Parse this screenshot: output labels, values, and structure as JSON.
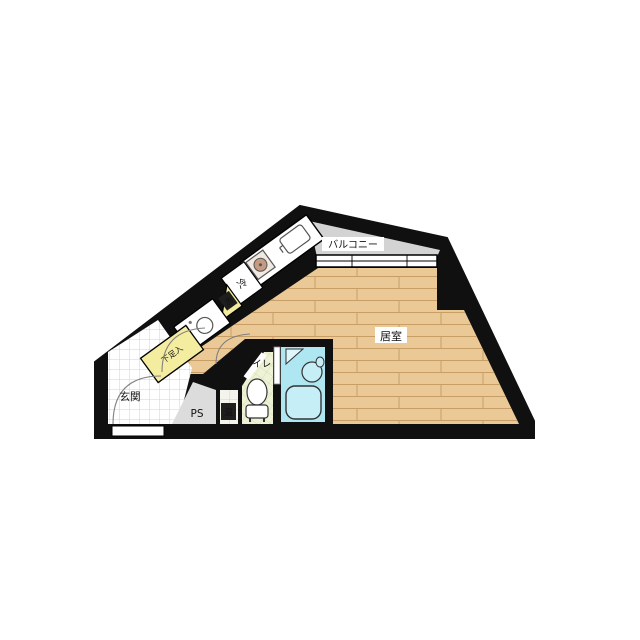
{
  "image": {
    "type": "apartment-floor-plan"
  },
  "labels": {
    "balcony": "バルコニー",
    "living_room": "居室",
    "entrance": "玄関",
    "toilet": "トイレ",
    "pipe_space": "PS",
    "water_heater": "温",
    "refrigerator": "冷",
    "shoe_cabinet": "下足入",
    "washer": "洗"
  },
  "colors": {
    "wall": "#101010",
    "wood_floor": "#ebc996",
    "wood_line": "#c79e66",
    "balcony_floor": "#d3d3d3",
    "bath_floor": "#aee6f2",
    "bath_fixture": "#c6eef7",
    "toilet_floor": "#eef3d7",
    "shoe_yellow": "#f4eda0",
    "entrance_floor": "#ffffff",
    "ps_floor": "#dcdcdc",
    "heater_floor": "#f4f4ec",
    "badge_dark": "#1e1e1e"
  }
}
